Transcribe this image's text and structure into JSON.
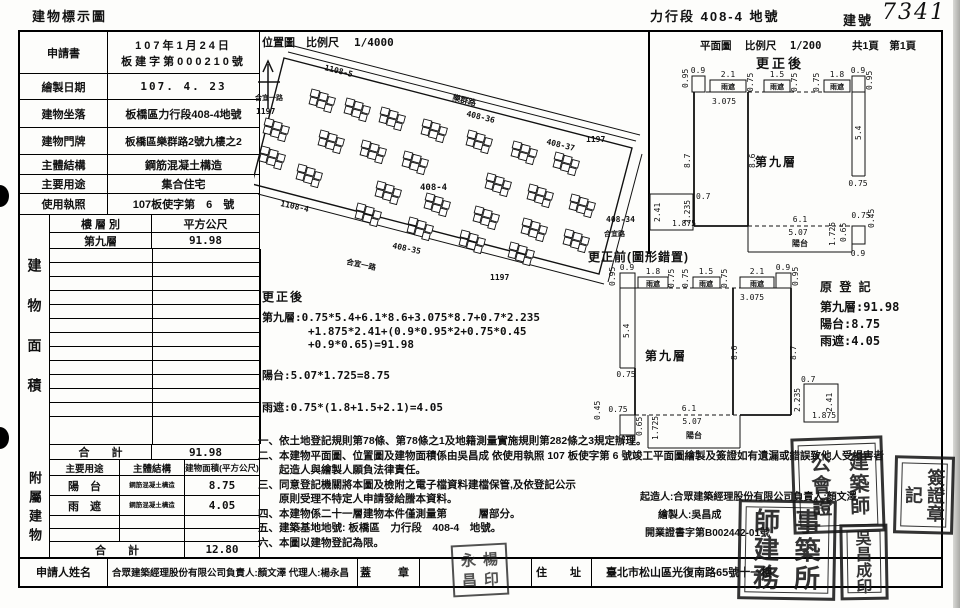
{
  "page": {
    "doc_title": "建物標示圖",
    "land_ref": "力行段  408-4  地號",
    "building_no_label": "建號",
    "building_no_value": "7341"
  },
  "info_table": {
    "rows": [
      {
        "label": "申請書",
        "value1": "107年1月24日",
        "value2": "板建字第000210號"
      },
      {
        "label": "繪製日期",
        "value": "107. 4. 23"
      },
      {
        "label": "建物坐落",
        "value": "板橋區力行段408-4地號"
      },
      {
        "label": "建物門牌",
        "value": "板橋區樂群路2號九樓之2"
      },
      {
        "label": "主體結構",
        "value": "鋼筋混凝土構造"
      },
      {
        "label": "主要用途",
        "value": "集合住宅"
      },
      {
        "label": "使用執照",
        "value": "107板使字第　6　號"
      }
    ]
  },
  "area_table": {
    "side_label": "建物面積",
    "col_floor": "樓 層 別",
    "col_area": "平方公尺",
    "floor1": "第九層",
    "area1": "91.98",
    "total_label": "合　　計",
    "total_value": "91.98"
  },
  "annex_table": {
    "side_label": "附屬建物",
    "col_use": "主要用途",
    "col_structure": "主體結構",
    "col_area": "建物面積(平方公尺)",
    "row1_use": "陽　台",
    "row1_structure": "鋼筋混凝土構造",
    "row1_area": "8.75",
    "row2_use": "雨　遮",
    "row2_structure": "鋼筋混凝土構造",
    "row2_area": "4.05",
    "total_label": "合　　計",
    "total_value": "12.80"
  },
  "bottom_row": {
    "applicant_label": "申請人姓名",
    "applicant_value": "合眾建築經理股份有限公司負責人:顏文澤 代理人:楊永昌",
    "seal_label": "蓋　章",
    "address_label": "住　址",
    "address_value": "臺北市松山區光復南路65號十一樓"
  },
  "site_plan": {
    "title": "位置圖",
    "scale_label": "比例尺",
    "scale": "1/4000",
    "labels": {
      "l1108_5": "1108-5",
      "road_top": "樂群路",
      "l408_36": "408-36",
      "l408_37": "408-37",
      "l1197_top": "1197",
      "road_left": "合宜一路",
      "l1197_left": "1197",
      "l1108_4": "1108-4",
      "l408_4": "408-4",
      "l408_35": "408-35",
      "road_bottom": "合宜一路",
      "l1197_bottom": "1197",
      "l408_34": "408-34",
      "road_right": "合宜路"
    }
  },
  "calc": {
    "title": "更正後",
    "line1": "第九層:0.75*5.4+6.1*8.6+3.075*8.7+0.7*2.235",
    "line2": "+1.875*2.41+(0.9*0.95*2+0.75*0.45",
    "line3": "+0.9*0.65)=91.98",
    "line4": "陽台:5.07*1.725=8.75",
    "line5": "雨遮:0.75*(1.8+1.5+2.1)=4.05"
  },
  "plan_header": {
    "title": "平面圖",
    "scale_label": "比例尺",
    "scale": "1/200",
    "pages": "共1頁　第1頁",
    "after_title": "更正後",
    "before_title": "更正前(圖形錯置)"
  },
  "plan_dims": {
    "w09": "0.9",
    "h095": "0.95",
    "e21": "2.1",
    "e15": "1.5",
    "e18": "1.8",
    "g075": "0.75",
    "w3075": "3.075",
    "L87": "8.7",
    "L86": "8.6",
    "L54": "5.4",
    "b61": "6.1",
    "b507": "5.07",
    "b1725": "1.725",
    "s065": "0.65",
    "s045": "0.45",
    "x241": "2.41",
    "x1875": "1.875",
    "x2235": "2.235",
    "x07": "0.7",
    "room": "第九層",
    "balcony": "陽台",
    "eave": "雨遮"
  },
  "orig_reg": {
    "title": "原 登 記",
    "line1": "第九層:91.98",
    "line2": "陽台:8.75",
    "line3": "雨遮:4.05"
  },
  "notes": {
    "n1": "一、依土地登記規則第78條、第78條之1及地籍測量實施規則第282條之3規定辦理。",
    "n2": "二、本建物平面圖、位置圖及建物面積係由吳昌成 依使用執照  107 板使字第  6  號竣工平面圖繪製及簽證如有遺漏或錯誤致他人受損害者",
    "n2b": "　　起造人與繪製人願負法律責任。",
    "n3": "三、同意登記機關將本圖及檢附之電子檔資料建檔保管,及依登記公示",
    "n3b": "　　原則受理不特定人申請發給謄本資料。",
    "n4": "四、本建物係二十一層建物本件僅測量第　　　層部分。",
    "n5": "五、建築基地地號: 板橋區　力行段　408-4　地號。",
    "n6": "六、本圖以建物登記為限。",
    "builder_line": "起造人:合眾建築經理股份有限公司負責人:顏文澤",
    "drafter_line": "繪製人:吳昌成",
    "license_line": "開業證書字第B002442-01號"
  },
  "seals": {
    "assoc": [
      "建",
      "築",
      "師",
      "公",
      "會",
      "證"
    ],
    "reg": [
      "簽",
      "證",
      "章",
      "記"
    ],
    "office": [
      "師",
      "事",
      "建",
      "築",
      "務",
      "所"
    ],
    "drafter": [
      "吳",
      "昌",
      "成",
      "印"
    ],
    "agent": [
      "永",
      "楊",
      "昌",
      "印"
    ]
  }
}
